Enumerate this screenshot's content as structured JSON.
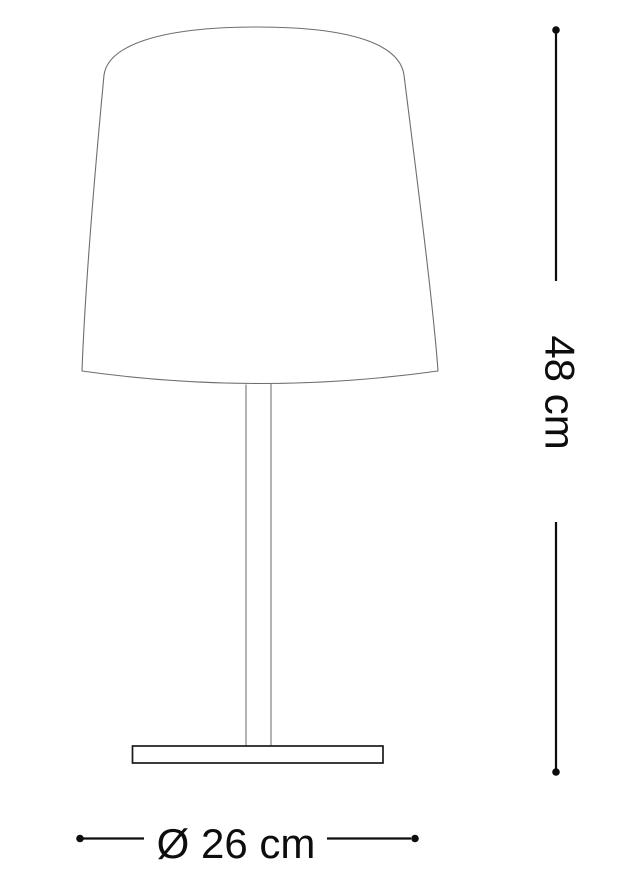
{
  "diagram": {
    "subject": "table-lamp-line-drawing",
    "dimensions": {
      "height": {
        "label": "48 cm",
        "orientation": "vertical"
      },
      "diameter": {
        "label": "Ø 26 cm",
        "orientation": "horizontal"
      }
    }
  },
  "colors": {
    "background": "#ffffff",
    "shade_outline": "#6e6e6e",
    "stem_outline": "#828282",
    "base_outline": "#1a1a1a",
    "dimension": "#0d0d0d"
  }
}
